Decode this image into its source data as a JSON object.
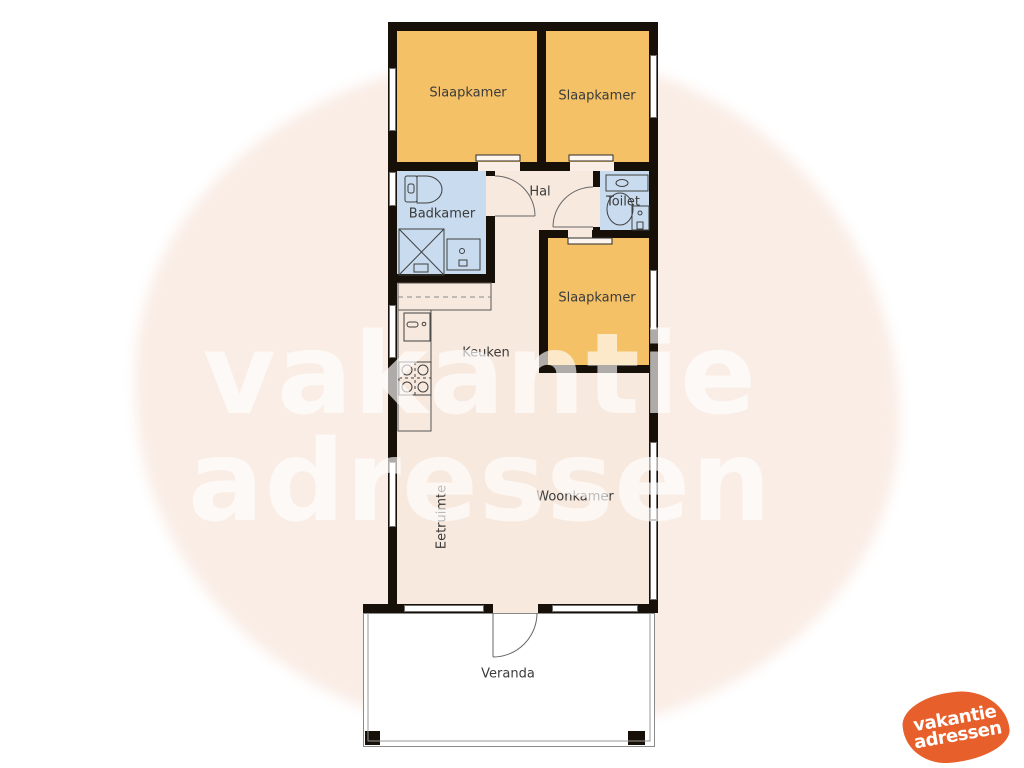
{
  "floorplan": {
    "rooms": {
      "bedroom1": "Slaapkamer",
      "bedroom2": "Slaapkamer",
      "bedroom3": "Slaapkamer",
      "bathroom": "Badkamer",
      "hall": "Hal",
      "toilet": "Toilet",
      "kitchen": "Keuken",
      "living": "Woonkamer",
      "dining": "Eetruimte",
      "veranda": "Veranda"
    },
    "colors": {
      "bedroom_fill": "#F4C167",
      "wet_room_fill": "#C9DCEF",
      "interior_fill": "#F8E9DE",
      "wall": "#171008",
      "background_blob": "#FAEDE6",
      "brand_orange": "#E75F2B"
    }
  },
  "watermark": {
    "line1": "vakantie",
    "line2": "adressen"
  },
  "logo": {
    "line1": "vakantie",
    "line2": "adressen"
  }
}
